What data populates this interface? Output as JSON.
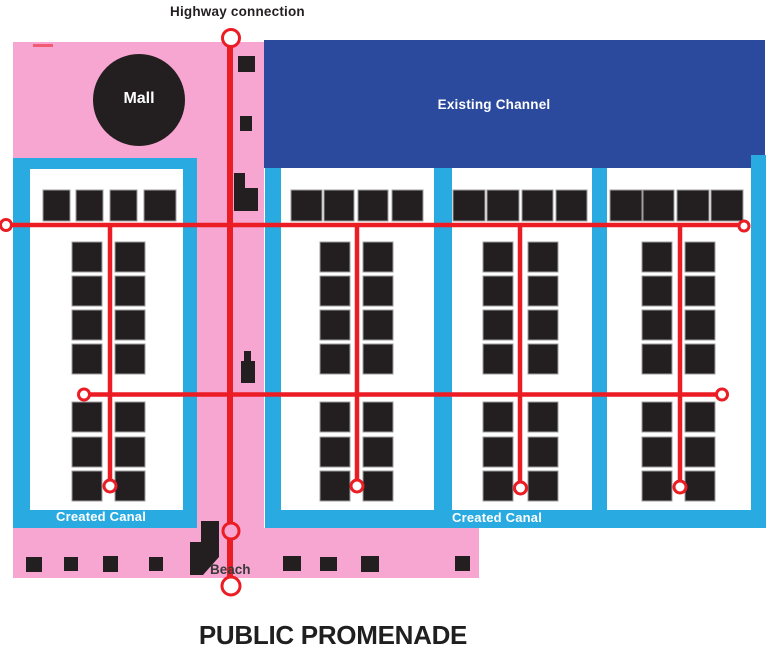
{
  "title": "PUBLIC PROMENADE",
  "labels": {
    "highway_connection": "Highway connection",
    "mall": "Mall",
    "existing_channel": "Existing Channel",
    "created_canal_west": "Created Canal",
    "created_canal_east": "Created Canal",
    "beach": "Beach"
  },
  "colors": {
    "pink": "#F7A6D2",
    "cyan": "#29ABE2",
    "navy": "#2B4A9D",
    "red": "#EC1C24",
    "black": "#231F20",
    "white": "#FFFFFF",
    "stroke_gray": "#9E9E9E"
  },
  "plan": {
    "width": 768,
    "height": 662,
    "regions": [
      {
        "name": "mall-plaza-area",
        "color": "pink",
        "rect": [
          13,
          42,
          251,
          118
        ]
      },
      {
        "name": "promenade-strip",
        "color": "pink",
        "rect": [
          197,
          158,
          67,
          370
        ]
      },
      {
        "name": "beach-area",
        "color": "pink",
        "rect": [
          13,
          528,
          466,
          50
        ]
      },
      {
        "name": "existing-channel",
        "color": "navy",
        "rect": [
          264,
          40,
          501,
          128
        ]
      },
      {
        "name": "canal-frame-west",
        "color": "cyan",
        "rect": [
          13,
          158,
          184,
          370
        ]
      },
      {
        "name": "canal-frame-west-interior",
        "color": "white",
        "rect": [
          30,
          169,
          153,
          341
        ]
      },
      {
        "name": "canal-strip-1",
        "color": "cyan",
        "rect": [
          265,
          168,
          16,
          360
        ]
      },
      {
        "name": "canal-strip-2",
        "color": "cyan",
        "rect": [
          434,
          168,
          18,
          360
        ]
      },
      {
        "name": "canal-strip-3",
        "color": "cyan",
        "rect": [
          592,
          168,
          15,
          360
        ]
      },
      {
        "name": "canal-strip-4",
        "color": "cyan",
        "rect": [
          751,
          155,
          15,
          373
        ]
      },
      {
        "name": "canal-bottom-bar",
        "color": "cyan",
        "rect": [
          265,
          510,
          501,
          18
        ]
      }
    ],
    "mall_circle": {
      "cx": 139,
      "cy": 100,
      "r": 46
    },
    "buildings": [
      [
        43,
        190,
        27,
        31
      ],
      [
        76,
        190,
        27,
        31
      ],
      [
        110,
        190,
        27,
        31
      ],
      [
        144,
        190,
        32,
        31
      ],
      [
        291,
        190,
        31,
        31
      ],
      [
        324,
        190,
        30,
        31
      ],
      [
        358,
        190,
        30,
        31
      ],
      [
        392,
        190,
        31,
        31
      ],
      [
        453,
        190,
        32,
        31
      ],
      [
        487,
        190,
        32,
        31
      ],
      [
        522,
        190,
        31,
        31
      ],
      [
        556,
        190,
        31,
        31
      ],
      [
        610,
        190,
        32,
        31
      ],
      [
        643,
        190,
        31,
        31
      ],
      [
        677,
        190,
        32,
        31
      ],
      [
        711,
        190,
        32,
        31
      ],
      [
        72,
        242,
        30,
        30
      ],
      [
        72,
        276,
        30,
        30
      ],
      [
        72,
        310,
        30,
        30
      ],
      [
        72,
        344,
        30,
        30
      ],
      [
        115,
        242,
        30,
        30
      ],
      [
        115,
        276,
        30,
        30
      ],
      [
        115,
        310,
        30,
        30
      ],
      [
        115,
        344,
        30,
        30
      ],
      [
        72,
        402,
        30,
        30
      ],
      [
        72,
        437,
        30,
        30
      ],
      [
        72,
        471,
        30,
        30
      ],
      [
        115,
        402,
        30,
        30
      ],
      [
        115,
        437,
        30,
        30
      ],
      [
        115,
        471,
        30,
        30
      ],
      [
        320,
        242,
        30,
        30
      ],
      [
        320,
        276,
        30,
        30
      ],
      [
        320,
        310,
        30,
        30
      ],
      [
        320,
        344,
        30,
        30
      ],
      [
        363,
        242,
        30,
        30
      ],
      [
        363,
        276,
        30,
        30
      ],
      [
        363,
        310,
        30,
        30
      ],
      [
        363,
        344,
        30,
        30
      ],
      [
        320,
        402,
        30,
        30
      ],
      [
        320,
        437,
        30,
        30
      ],
      [
        320,
        471,
        30,
        30
      ],
      [
        363,
        402,
        30,
        30
      ],
      [
        363,
        437,
        30,
        30
      ],
      [
        363,
        471,
        30,
        30
      ],
      [
        483,
        242,
        30,
        30
      ],
      [
        483,
        276,
        30,
        30
      ],
      [
        483,
        310,
        30,
        30
      ],
      [
        483,
        344,
        30,
        30
      ],
      [
        528,
        242,
        30,
        30
      ],
      [
        528,
        276,
        30,
        30
      ],
      [
        528,
        310,
        30,
        30
      ],
      [
        528,
        344,
        30,
        30
      ],
      [
        483,
        402,
        30,
        30
      ],
      [
        483,
        437,
        30,
        30
      ],
      [
        483,
        471,
        30,
        30
      ],
      [
        528,
        402,
        30,
        30
      ],
      [
        528,
        437,
        30,
        30
      ],
      [
        528,
        471,
        30,
        30
      ],
      [
        642,
        242,
        30,
        30
      ],
      [
        642,
        276,
        30,
        30
      ],
      [
        642,
        310,
        30,
        30
      ],
      [
        642,
        344,
        30,
        30
      ],
      [
        685,
        242,
        30,
        30
      ],
      [
        685,
        276,
        30,
        30
      ],
      [
        685,
        310,
        30,
        30
      ],
      [
        685,
        344,
        30,
        30
      ],
      [
        642,
        402,
        30,
        30
      ],
      [
        642,
        437,
        30,
        30
      ],
      [
        642,
        471,
        30,
        30
      ],
      [
        685,
        402,
        30,
        30
      ],
      [
        685,
        437,
        30,
        30
      ],
      [
        685,
        471,
        30,
        30
      ]
    ],
    "features": [
      {
        "name": "promenade-structure",
        "rect": [
          238,
          56,
          17,
          16
        ]
      },
      {
        "name": "promenade-structure",
        "rect": [
          240,
          116,
          12,
          15
        ]
      },
      {
        "name": "promenade-structure",
        "rect": [
          234,
          173,
          11,
          38
        ]
      },
      {
        "name": "promenade-structure",
        "rect": [
          234,
          188,
          24,
          23
        ]
      },
      {
        "name": "promenade-structure",
        "rect": [
          244,
          351,
          7,
          11
        ]
      },
      {
        "name": "promenade-structure",
        "rect": [
          241,
          361,
          14,
          22
        ]
      },
      {
        "name": "beach-structure",
        "rect": [
          26,
          557,
          16,
          15
        ]
      },
      {
        "name": "beach-structure",
        "rect": [
          64,
          557,
          14,
          14
        ]
      },
      {
        "name": "beach-structure",
        "rect": [
          103,
          556,
          15,
          16
        ]
      },
      {
        "name": "beach-structure",
        "rect": [
          149,
          557,
          14,
          14
        ]
      },
      {
        "name": "beach-structure",
        "rect": [
          283,
          556,
          18,
          15
        ]
      },
      {
        "name": "beach-structure",
        "rect": [
          320,
          557,
          17,
          14
        ]
      },
      {
        "name": "beach-structure",
        "rect": [
          361,
          556,
          18,
          16
        ]
      },
      {
        "name": "beach-structure",
        "rect": [
          455,
          556,
          15,
          15
        ]
      }
    ],
    "beach_access_polygon": "201,521 219,521 219,557 203,575 190,575 190,542 201,542",
    "corner_mark": [
      33,
      44,
      20,
      3
    ],
    "roads": {
      "line_width": 4.5,
      "highway_width": 6,
      "h_lines": [
        [
          6,
          225,
          744
        ],
        [
          84,
          394.5,
          723
        ]
      ],
      "v_lines": [
        [
          110,
          224,
          486
        ],
        [
          357,
          224,
          486
        ],
        [
          520,
          224,
          488
        ],
        [
          680,
          224,
          487
        ]
      ],
      "highway_line": [
        230,
        38,
        586
      ],
      "nodes": [
        [
          6,
          225,
          5.5,
          "white"
        ],
        [
          744,
          226,
          5,
          "white"
        ],
        [
          84,
          394.5,
          5.5,
          "white"
        ],
        [
          722,
          394.5,
          5.5,
          "white"
        ],
        [
          110,
          486,
          6,
          "white"
        ],
        [
          357,
          486,
          6,
          "white"
        ],
        [
          520.5,
          488,
          6,
          "white"
        ],
        [
          680,
          487,
          6,
          "white"
        ],
        [
          231,
          38,
          8.5,
          "white"
        ],
        [
          231,
          531,
          8,
          "pink"
        ],
        [
          231,
          586,
          9,
          "white"
        ]
      ]
    }
  }
}
